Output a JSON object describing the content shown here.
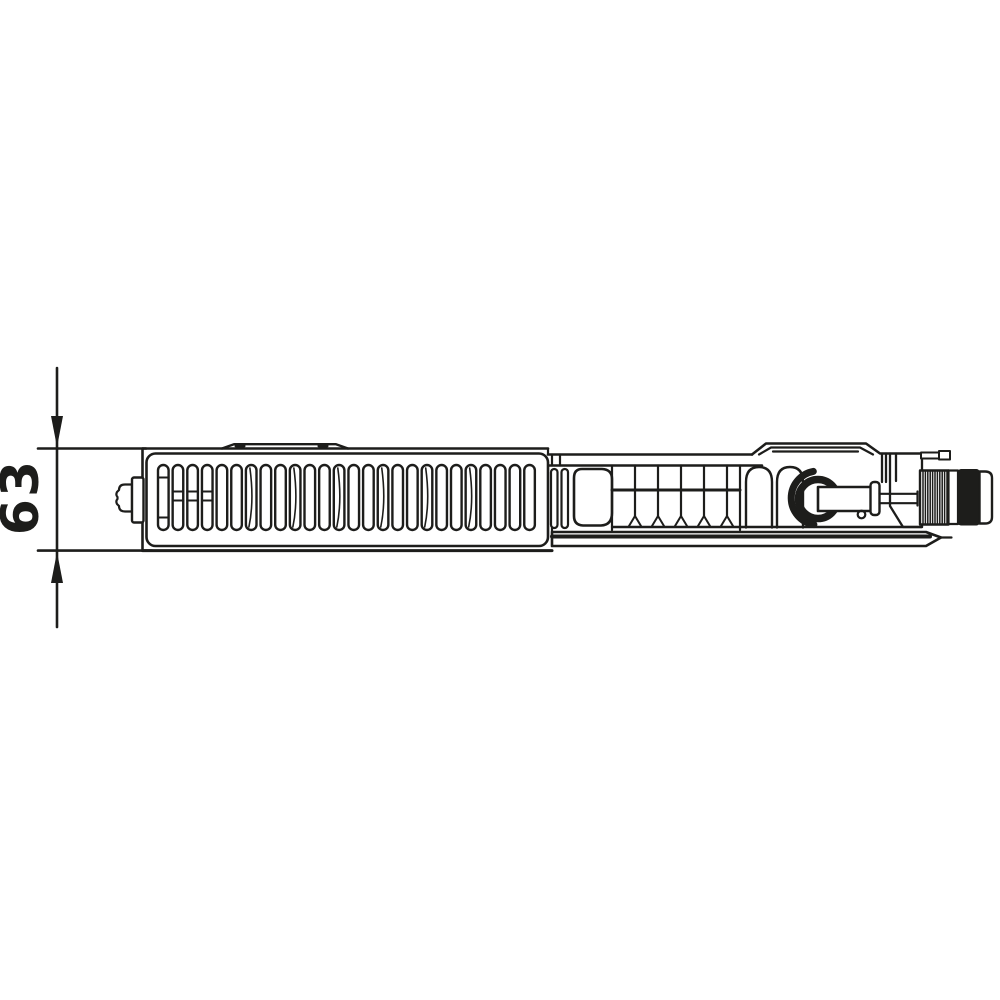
{
  "page": {
    "background_color": "#ffffff"
  },
  "dimension": {
    "label": "63"
  },
  "drawing": {
    "ink_color": "#1d1d1b",
    "paper_color": "#ffffff",
    "subject": "panel-radiator-top-view-technical-drawing",
    "grille_slot_count": 26,
    "thread_hatch_count": 11
  }
}
